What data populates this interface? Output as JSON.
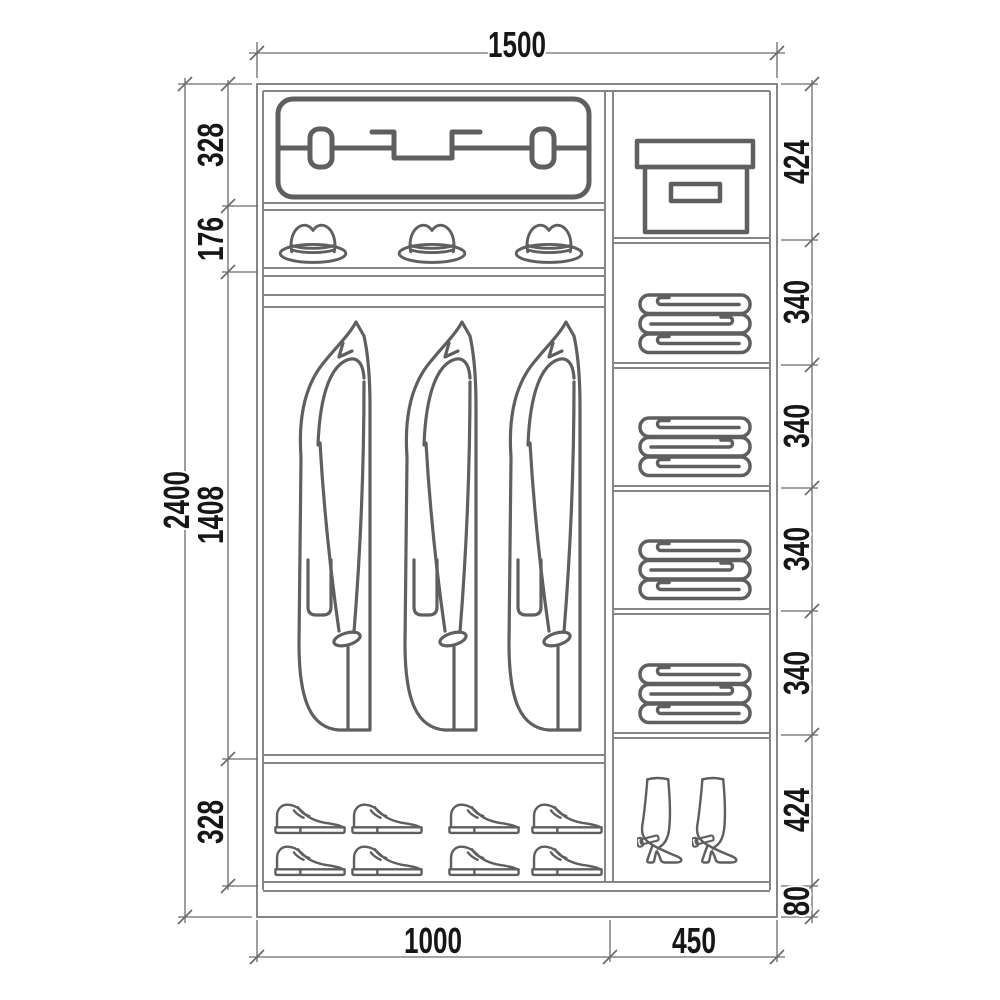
{
  "dims": {
    "total_width": "1500",
    "total_height": "2400",
    "left": [
      "328",
      "176",
      "1408",
      "328"
    ],
    "right": [
      "424",
      "340",
      "340",
      "340",
      "340",
      "424",
      "80"
    ],
    "bottom": [
      "1000",
      "450"
    ]
  },
  "colors": {
    "background": "#ffffff",
    "panel_line": "#868686",
    "dimension_line": "#6b6b6b",
    "dimension_text": "#161616",
    "icon_stroke": "#5f5f5f"
  },
  "icons": {
    "left_column": [
      "suitcase-icon",
      "hat-icon",
      "coat-icon",
      "shoe-icon"
    ],
    "right_column": [
      "storage-box-icon",
      "folded-linen-icon",
      "boot-icon"
    ]
  }
}
